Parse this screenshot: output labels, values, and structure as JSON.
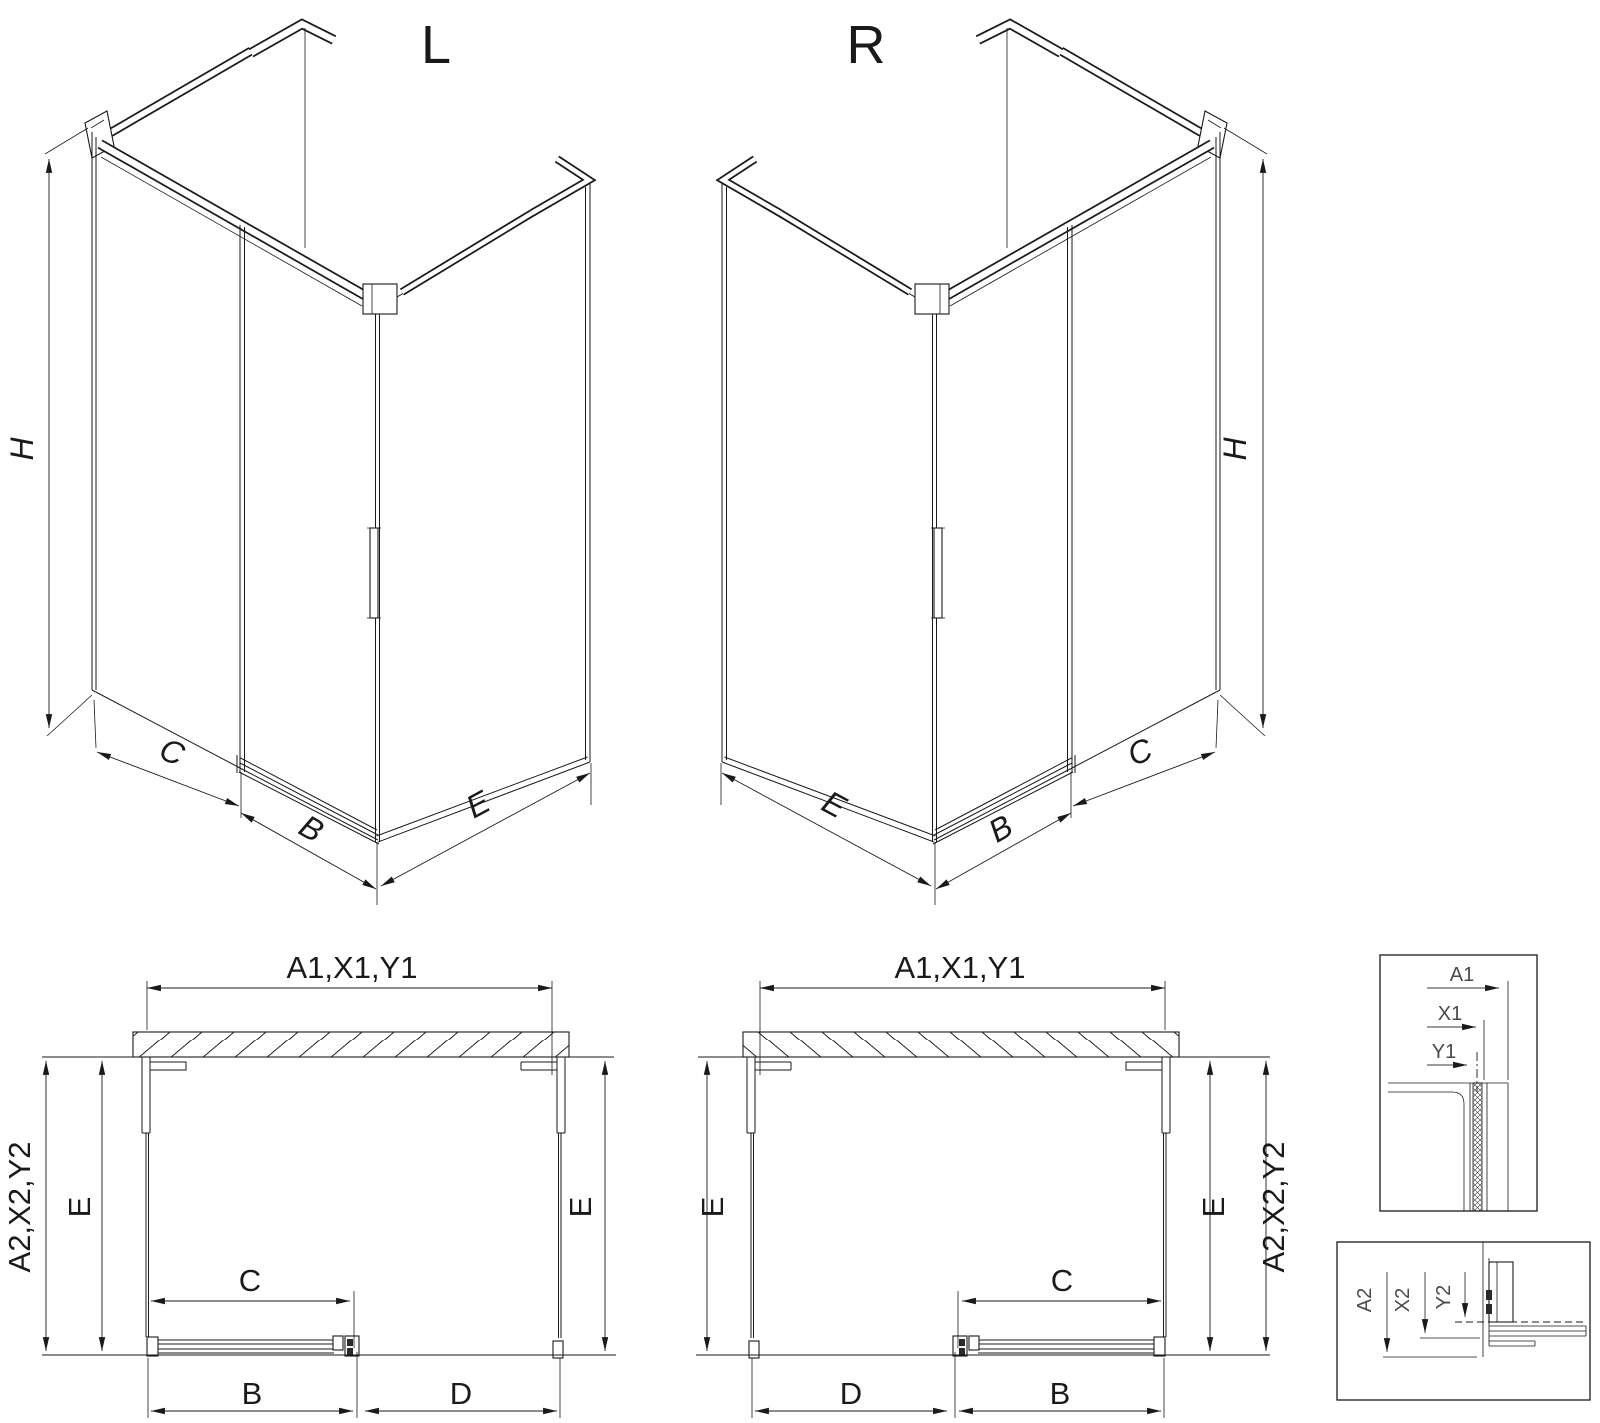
{
  "drawing": {
    "background": "#ffffff",
    "line_color": "#1a1a1a",
    "detail_text_color": "#4a4a4a",
    "iso_left": {
      "label": "L",
      "dim_height": "H",
      "dim_fixed": "C",
      "dim_door": "B",
      "dim_side": "E"
    },
    "iso_right": {
      "label": "R",
      "dim_height": "H",
      "dim_fixed": "C",
      "dim_door": "B",
      "dim_side": "E"
    },
    "plan_left": {
      "dim_top": "A1,X1,Y1",
      "dim_side_outer": "A2,X2,Y2",
      "dim_left": "E",
      "dim_right": "E",
      "dim_entry": "C",
      "dim_door": "B",
      "dim_opening": "D"
    },
    "plan_right": {
      "dim_top": "A1,X1,Y1",
      "dim_side_outer": "A2,X2,Y2",
      "dim_left": "E",
      "dim_right": "E",
      "dim_entry": "C",
      "dim_door": "B",
      "dim_opening": "D"
    },
    "detail_top": {
      "dim_a": "A1",
      "dim_x": "X1",
      "dim_y": "Y1"
    },
    "detail_bottom": {
      "dim_a": "A2",
      "dim_x": "X2",
      "dim_y": "Y2"
    }
  }
}
